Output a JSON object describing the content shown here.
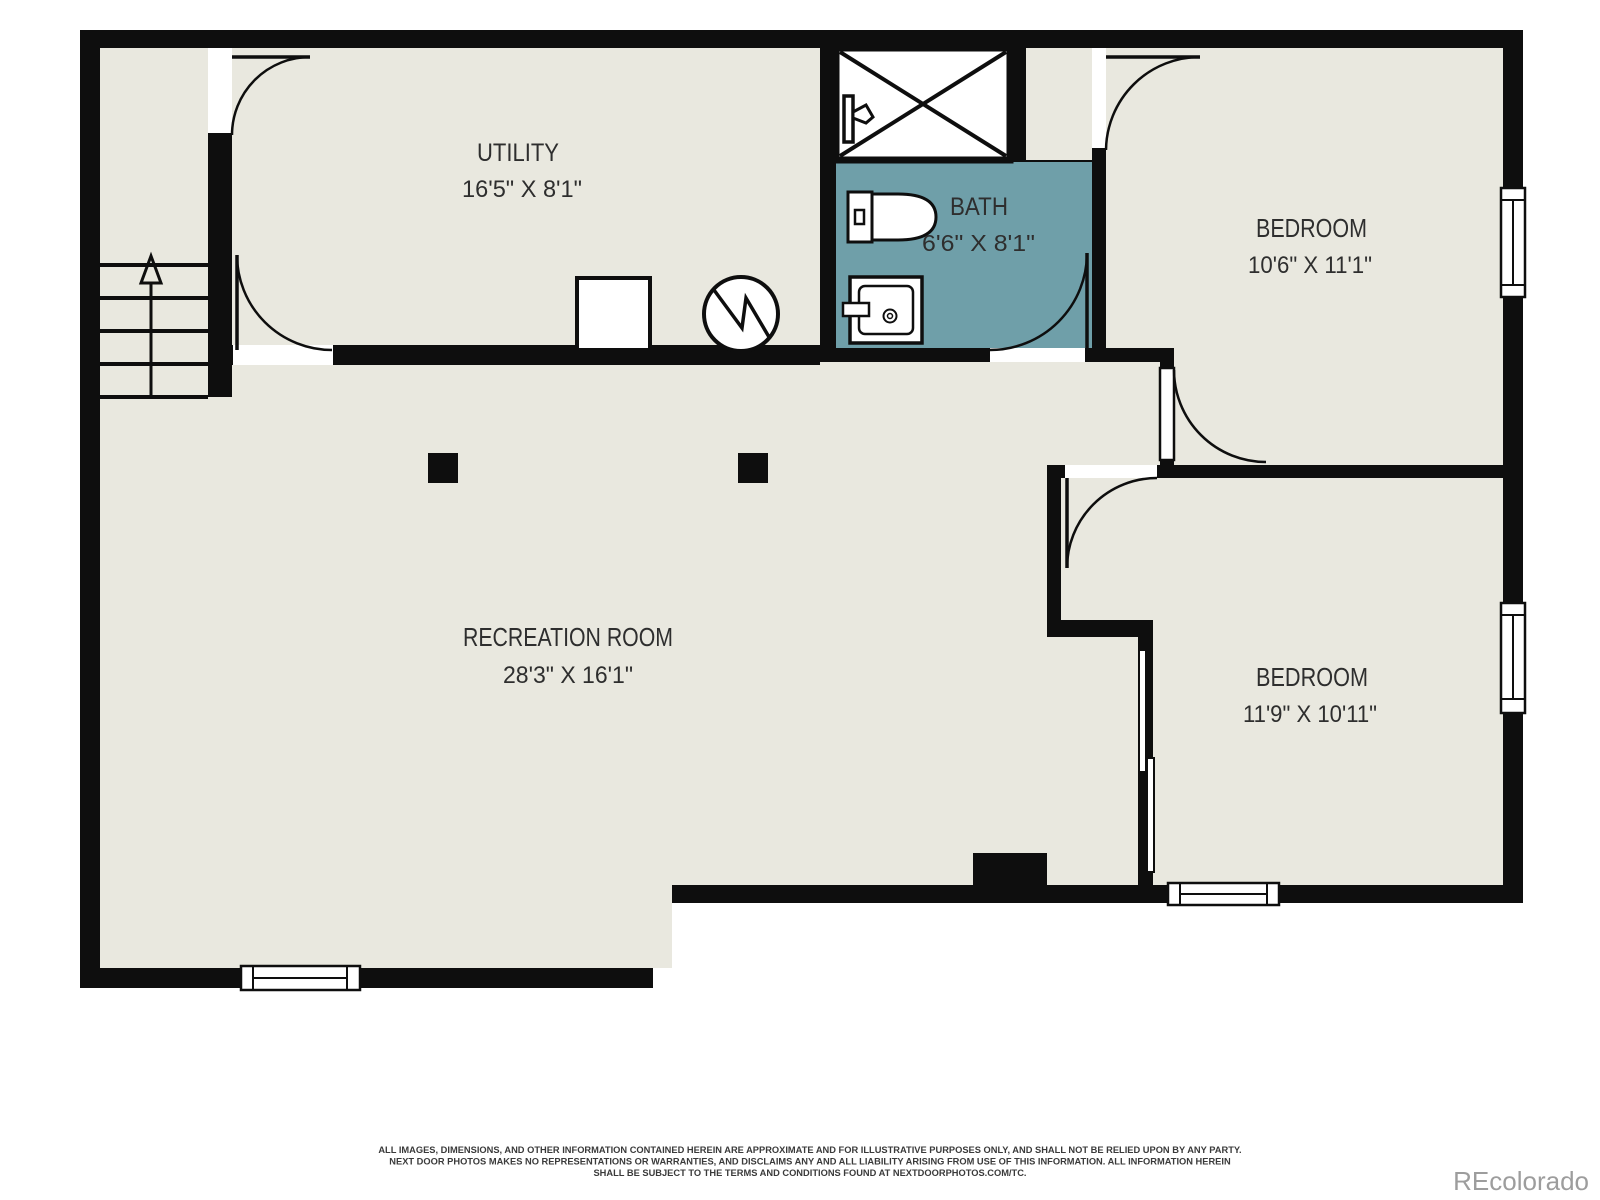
{
  "plan": {
    "watermark": "REcolorado",
    "colors": {
      "floor": "#e9e8df",
      "bath_fill": "#6f9fa9",
      "wall": "#0e0e0e",
      "label_text": "#2e2e2e",
      "watermark_gray": "#9d9d9d"
    },
    "rooms": [
      {
        "id": "utility",
        "name": "UTILITY",
        "dims": "16'5\" X 8'1\""
      },
      {
        "id": "bath",
        "name": "BATH",
        "dims": "6'6\" X 8'1\""
      },
      {
        "id": "bedroom-top",
        "name": "BEDROOM",
        "dims": "10'6\" X 11'1\""
      },
      {
        "id": "recreation",
        "name": "RECREATION ROOM",
        "dims": "28'3\" X 16'1\""
      },
      {
        "id": "bedroom-bottom",
        "name": "BEDROOM",
        "dims": "11'9\" X 10'11\""
      }
    ],
    "symbols": [
      "stairs-up-arrow",
      "shower-x",
      "shower-valve-icon",
      "toilet-icon",
      "sink-vanity-icon",
      "water-heater-circle-icon",
      "appliance-square-icon",
      "door-swing-arc",
      "window-symbol",
      "support-post",
      "closet-sliding-doors"
    ],
    "disclaimer": {
      "line1": "ALL IMAGES, DIMENSIONS, AND OTHER INFORMATION CONTAINED HEREIN ARE APPROXIMATE AND FOR ILLUSTRATIVE PURPOSES ONLY, AND SHALL NOT BE RELIED UPON BY ANY PARTY.",
      "line2": "NEXT DOOR PHOTOS MAKES NO REPRESENTATIONS OR WARRANTIES, AND DISCLAIMS ANY AND ALL LIABILITY ARISING FROM USE OF THIS INFORMATION. ALL INFORMATION HEREIN",
      "line3": "SHALL BE SUBJECT TO THE TERMS AND CONDITIONS FOUND AT NEXTDOORPHOTOS.COM/TC."
    }
  }
}
